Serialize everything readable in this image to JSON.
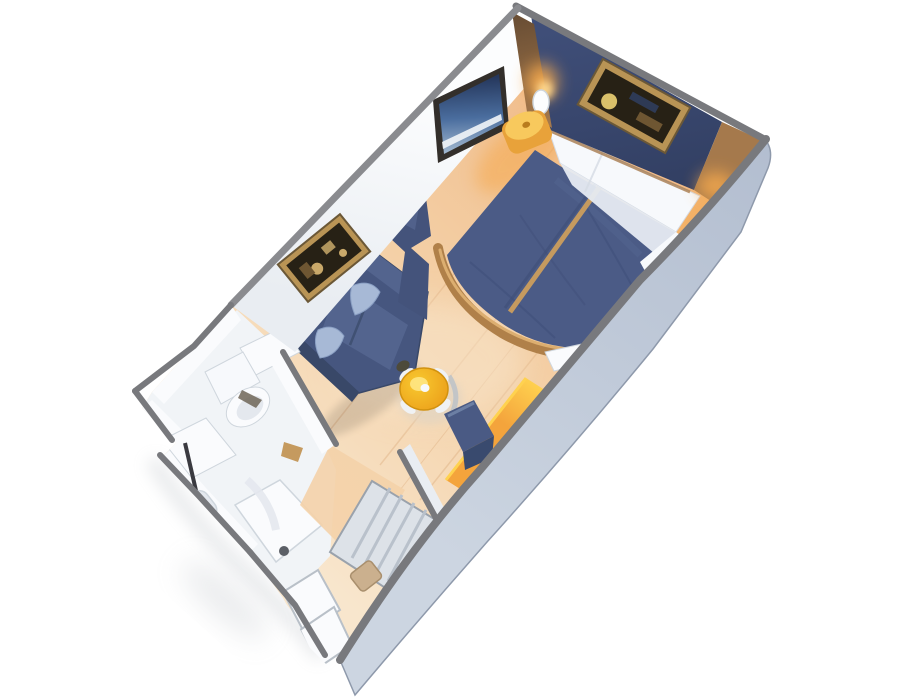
{
  "page": {
    "title": "3D Stateroom Floor Plan Rendering"
  },
  "scene": {
    "type": "isometric-cutaway-room",
    "rooms": [
      "bedroom-living-area",
      "bathroom",
      "entry-corridor",
      "closet-nook"
    ],
    "items": [
      "double-bed",
      "pillows",
      "bed-wood-rail",
      "headboard-accent-wall",
      "bedroom-wall-art",
      "wall-sconce",
      "vanity-mirror-oval",
      "nightstand-stool",
      "wall-tv",
      "loveseat-sofa",
      "sofa-throw-pillows",
      "lounge-chair",
      "living-wall-art",
      "round-coffee-table",
      "floor-object",
      "desk-counter",
      "desk-stool",
      "towel",
      "toilet",
      "sink-vanity",
      "shower-tray",
      "shower-drain",
      "wardrobe-shelves",
      "storage-basket",
      "closet-doors",
      "entry-door-panels",
      "wood-floor"
    ]
  },
  "palette": {
    "bg": "#ffffff",
    "capGray": "#78797d",
    "capGray2": "#8a8b8f",
    "panelLight": "#ccd5e1",
    "panelMid": "#b3bed0",
    "panelEdge": "#8e99ab",
    "wallWhite": "#fcfdfe",
    "wallShade": "#e9edf2",
    "bathWhite": "#f1f4f7",
    "fixWhite": "#fafbfd",
    "fixStroke": "#cfd6dd",
    "fixShade": "#e4e8ee",
    "navyWall": "#3f4e78",
    "navyWallDark": "#313e61",
    "woodDark": "#6b4f35",
    "woodLit": "#a5794c",
    "glowOrange": "#f5a94e",
    "glowYellow": "#ffd98f",
    "floorWarm": "#f0ba88",
    "floorMid": "#f4d1a8",
    "floorPale": "#f8e6cd",
    "plank": "#d8a474",
    "bedNavy": "#4b5b86",
    "bedNavyDark": "#3e4d77",
    "bedNavyLight": "#5a6a94",
    "sheetWhite": "#f7f9fc",
    "sheetShade": "#e6ebf2",
    "sheetStroke": "#d5dbe4",
    "woodRail": "#b08049",
    "woodRailLight": "#dcae70",
    "woodStrip": "#c59a5f",
    "sofaNavy": "#46567f",
    "sofaNavyDark": "#394868",
    "sofaNavyLight": "#53648e",
    "pillowBlue": "#a7b9d6",
    "pillowBlueStroke": "#8ba0c4",
    "chairNavy": "#44537b",
    "tableYellow": "#f8c930",
    "tableOrange": "#eda41c",
    "tableEdge": "#d1920f",
    "tableHighlight": "#ffe98a",
    "petalWhite": "#f0f2f4",
    "tableShadow": "#d8d0c4",
    "deskOrange": "#f4a43c",
    "deskYellow": "#ffd24f",
    "stoolNavy": "#4a5a84",
    "stoolNavyDark": "#394a6e",
    "stoolHighlight": "#7488ad",
    "stoolOrange": "#e8a23a",
    "stoolOrangeTop": "#f8c95d",
    "stoolDot": "#b97c1e",
    "tvFrame": "#332f2b",
    "tvTop": "#25375c",
    "tvMid": "#4a6d9e",
    "tvLow": "#9db4cd",
    "horizonWhite": "#f2f5f8",
    "frameGold": "#b99455",
    "frameGoldDark": "#6b5837",
    "artDark": "#272115",
    "artTan": "#c9a96a",
    "artBrown": "#6e5632",
    "artNavy": "#2e3a55",
    "artMoon": "#d9c06a",
    "drainGray": "#5b5f66",
    "seamDark": "#3a3a40",
    "basketTan": "#cbb08e",
    "basketStroke": "#a98f6d",
    "shadowSoft": "#a8aeb6",
    "objOlive": "#4d4a3a",
    "stripeGray": "#b9c1cb",
    "closetFace": "#dde2e8",
    "closetStroke": "#9aa2ac",
    "toiletGap": "#6e6557",
    "sinkDrain": "#b9c0c8"
  }
}
